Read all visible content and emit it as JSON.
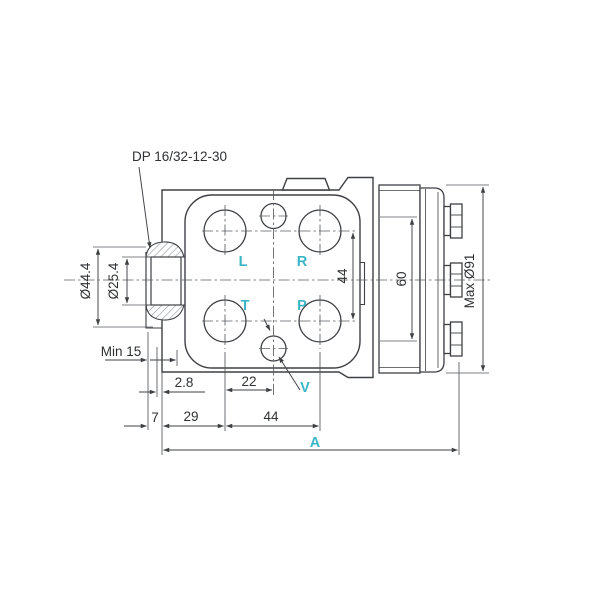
{
  "drawing": {
    "note_spline": "DP 16/32-12-30",
    "ports": {
      "L": "L",
      "R": "R",
      "T": "T",
      "P": "P",
      "V": "V"
    },
    "dims": {
      "outer_dia": "Ø44.4",
      "inner_dia": "Ø25.4",
      "min_engagement": "Min 15",
      "face_offset": "2.8",
      "v_offset": "22",
      "flange_width": "7",
      "port_col_offset": "29",
      "port_spacing_h": "44",
      "port_spacing_v": "44",
      "motor_section": "60",
      "max_diameter": "Max Ø91",
      "overall_length": "A"
    },
    "colors": {
      "accent_cyan": "#3ab6c6",
      "line_dark": "#3e4044"
    }
  }
}
